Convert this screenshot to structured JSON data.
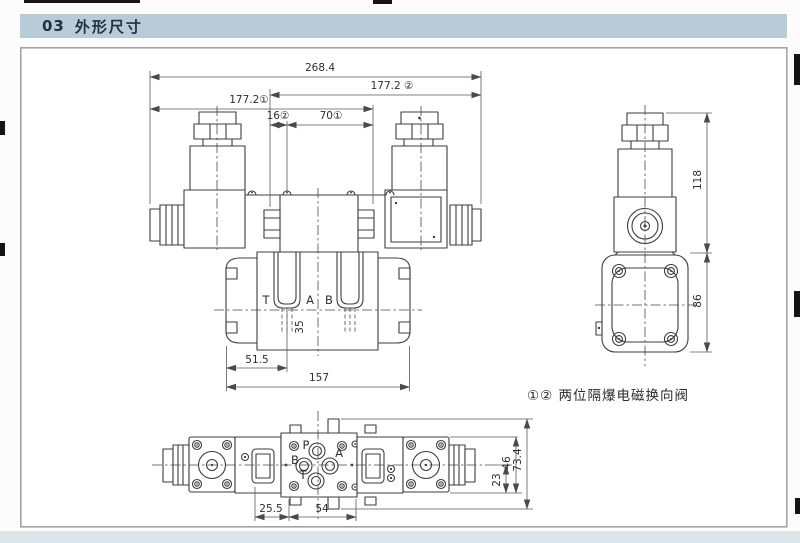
{
  "header": {
    "section_no": "03",
    "title": "外形尺寸"
  },
  "drawing": {
    "caption": "①② 两位隔爆电磁换向阀",
    "front_view": {
      "dim_total_width": "268.4",
      "dim_width_variant2": "177.2 ②",
      "dim_width_variant1": "177.2①",
      "dim_offset_16": "16②",
      "dim_offset_70": "70①",
      "dim_35": "35",
      "dim_51_5": "51.5",
      "dim_157": "157",
      "port_t": "T",
      "port_a": "A",
      "port_b": "B"
    },
    "side_view": {
      "dim_118": "118",
      "dim_86": "86"
    },
    "bottom_view": {
      "port_p": "P",
      "port_a": "A",
      "port_b": "B",
      "port_t": "T",
      "dim_25_5": "25.5",
      "dim_54": "54",
      "dim_23": "23",
      "dim_46": "46",
      "dim_73_4": "73.4"
    }
  },
  "colors": {
    "header_bg": "#b7cbd8",
    "header_text": "#24313c",
    "line_color": "#3d3d3d",
    "panel_border": "#a0a4a7",
    "page_bg": "#fcfcfc",
    "bottom_strip": "#dde5ea"
  }
}
